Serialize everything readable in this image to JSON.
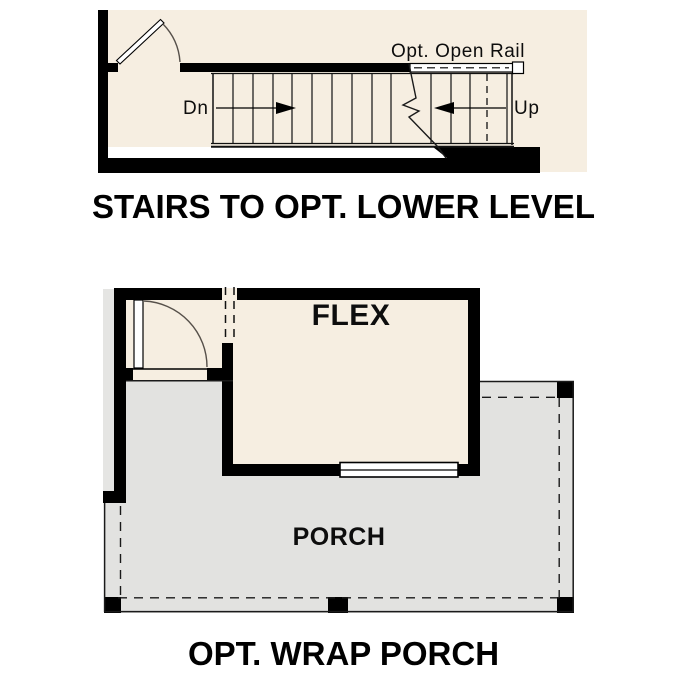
{
  "colors": {
    "floor_beige": "#f6eee1",
    "porch_gray": "#e2e2e0",
    "wall_black": "#000000",
    "line_dark": "#1a1a1a"
  },
  "stairs_diagram": {
    "title": "STAIRS TO OPT. LOWER LEVEL",
    "labels": {
      "rail": "Opt. Open Rail",
      "down": "Dn",
      "up": "Up"
    }
  },
  "porch_plan": {
    "title": "OPT. WRAP PORCH",
    "rooms": [
      {
        "name": "FLEX"
      },
      {
        "name": "PORCH"
      }
    ]
  }
}
